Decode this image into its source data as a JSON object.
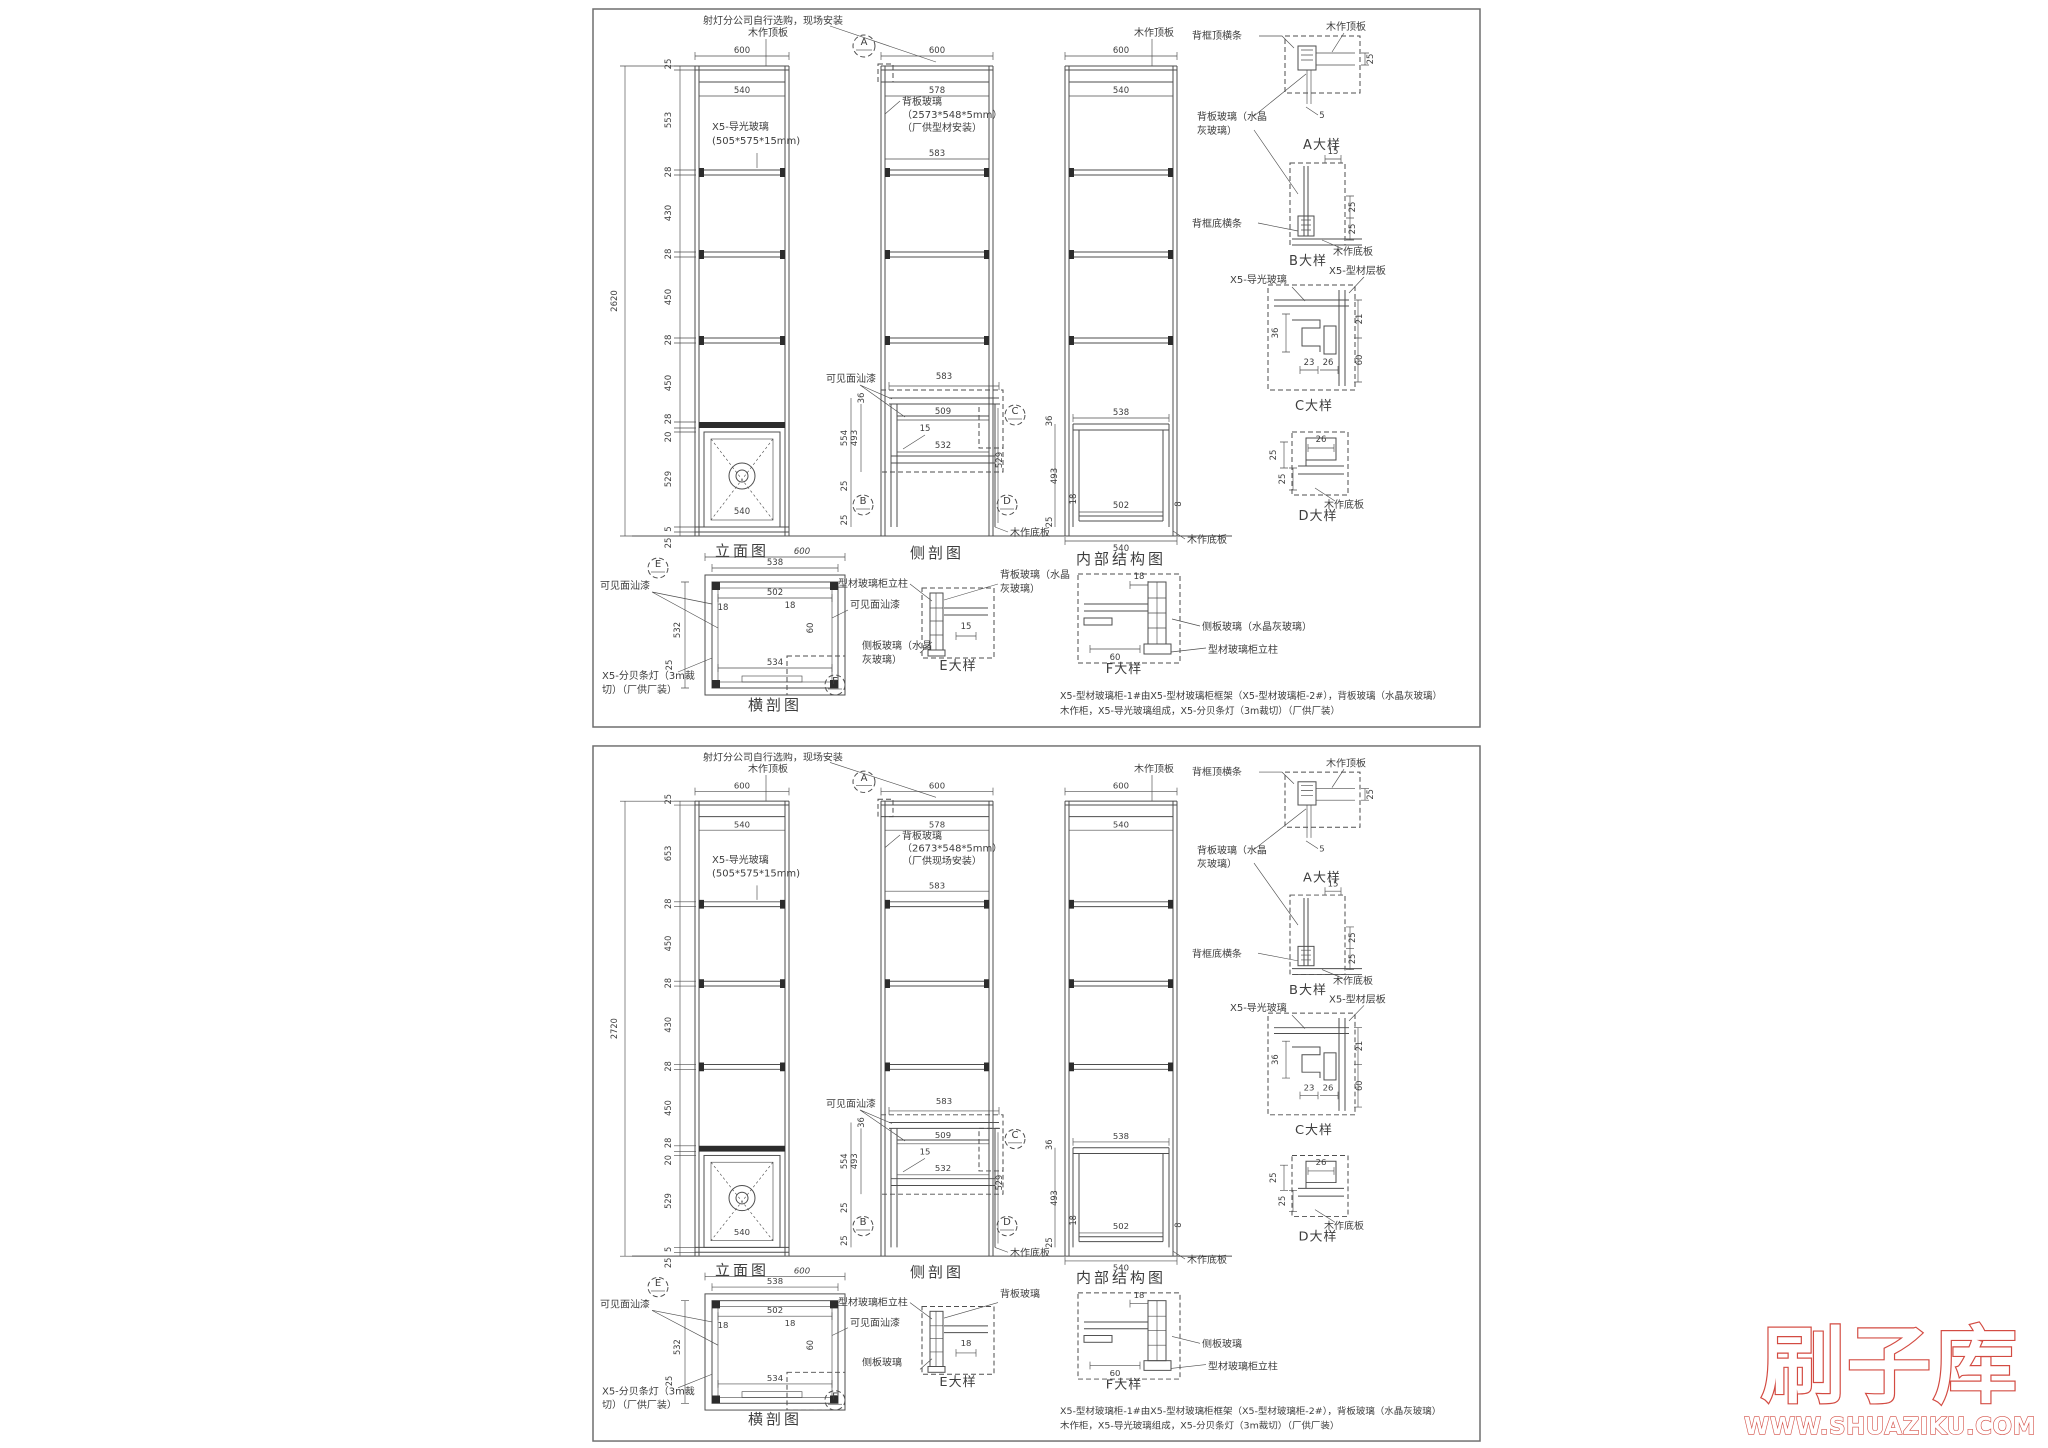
{
  "watermark": {
    "brand": "刷子库",
    "site": "WWW.SHUAZIKU.COM",
    "color": "#d34b42"
  },
  "line_color": "#4e4e4e",
  "sheets": [
    {
      "top_note": "射灯分公司自行选购，现场安装",
      "elev": {
        "title": "立面图",
        "width": "600",
        "inner_width": "540",
        "lamp_width": "540",
        "overall": "2620",
        "segs": [
          "25",
          "553",
          "28",
          "430",
          "28",
          "450",
          "28",
          "450",
          "28",
          "20",
          "529",
          "5",
          "25"
        ],
        "top_panel": "木作顶板",
        "glass1": "X5-导光玻璃",
        "glass2": "(505*575*15mm)"
      },
      "side": {
        "title": "侧剖图",
        "width": "600",
        "inner_top": "578",
        "bg1": "背板玻璃",
        "bg2": "（2573*548*5mm）",
        "bg3": "（厂供型材安装）",
        "shelf_w": "583",
        "marker_a": "A",
        "paint": "可见面汕漆",
        "bench_top": "583",
        "bench_mid": "509",
        "bench_bot": "532",
        "glass_t": "15",
        "h1": "554",
        "h2": "493",
        "h3": "529",
        "t36": "36",
        "b25a": "25",
        "b25b": "25",
        "marker_b": "B",
        "marker_c": "C",
        "marker_d": "D",
        "bottom_panel": "木作底板"
      },
      "inner": {
        "title": "内部结构图",
        "width": "600",
        "inner_width": "540",
        "top_panel": "木作顶板",
        "w538": "538",
        "w502": "502",
        "w540": "540",
        "g8": "8",
        "t36": "36",
        "h493": "493",
        "b18": "18",
        "b25": "25",
        "bottom_panel": "木作底板"
      },
      "cross": {
        "title": "横剖图",
        "width": "600",
        "w538": "538",
        "w502": "502",
        "h532": "532",
        "w534": "534",
        "h60": "60",
        "t18a": "18",
        "t18b": "18",
        "b25": "25",
        "paint_l": "可见面汕漆",
        "paint_r": "可见面汕漆",
        "lamp1": "X5-分贝条灯（3m裁",
        "lamp2": "切）（厂供厂装）",
        "marker_e": "E",
        "marker_f": "F"
      },
      "da": {
        "name": "A大样",
        "rail": "背框顶横条",
        "panel": "木作顶板",
        "g1": "背板玻璃（水晶",
        "g2": "灰玻璃）",
        "d25": "25",
        "d5": "5"
      },
      "db": {
        "name": "B大样",
        "rail": "背框底横条",
        "panel": "木作底板",
        "d15": "15",
        "d25a": "25",
        "d25b": "25",
        "shelf": "X5-型材层板"
      },
      "dc": {
        "name": "C大样",
        "glass": "X5-导光玻璃",
        "d36": "36",
        "d23": "23",
        "d26": "26",
        "d21": "21",
        "d60": "60"
      },
      "dd": {
        "name": "D大样",
        "d26": "26",
        "d25a": "25",
        "d25b": "25",
        "panel": "木作底板"
      },
      "de": {
        "name": "E大样",
        "post": "型材玻璃柜立柱",
        "b1": "背板玻璃（水晶",
        "b2": "灰玻璃）",
        "s1": "侧板玻璃（水晶",
        "s2": "灰玻璃）",
        "d15": "15"
      },
      "df": {
        "name": "F大样",
        "d18": "18",
        "d60": "60",
        "side": "侧板玻璃（水晶灰玻璃）",
        "post": "型材玻璃柜立柱"
      },
      "cap1": "X5-型材玻璃柜-1#由X5-型材玻璃柜框架（X5-型材玻璃柜-2#），背板玻璃（水晶灰玻璃）",
      "cap2": "木作柜，X5-导光玻璃组成，X5-分贝条灯（3m裁切）（厂供厂装）"
    },
    {
      "top_note": "射灯分公司自行选购，现场安装",
      "elev": {
        "title": "立面图",
        "width": "600",
        "inner_width": "540",
        "lamp_width": "540",
        "overall": "2720",
        "segs": [
          "25",
          "653",
          "28",
          "450",
          "28",
          "430",
          "28",
          "450",
          "28",
          "20",
          "529",
          "5",
          "25"
        ],
        "top_panel": "木作顶板",
        "glass1": "X5-导光玻璃",
        "glass2": "(505*575*15mm)"
      },
      "side": {
        "title": "侧剖图",
        "width": "600",
        "inner_top": "578",
        "bg1": "背板玻璃",
        "bg2": "（2673*548*5mm）",
        "bg3": "（厂供现场安装）",
        "shelf_w": "583",
        "marker_a": "A",
        "paint": "可见面汕漆",
        "bench_top": "583",
        "bench_mid": "509",
        "bench_bot": "532",
        "glass_t": "15",
        "h1": "554",
        "h2": "493",
        "h3": "529",
        "t36": "36",
        "b25a": "25",
        "b25b": "25",
        "marker_b": "B",
        "marker_c": "C",
        "marker_d": "D",
        "bottom_panel": "木作底板"
      },
      "inner": {
        "title": "内部结构图",
        "width": "600",
        "inner_width": "540",
        "top_panel": "木作顶板",
        "w538": "538",
        "w502": "502",
        "w540": "540",
        "g8": "8",
        "t36": "36",
        "h493": "493",
        "b18": "18",
        "b25": "25",
        "bottom_panel": "木作底板"
      },
      "cross": {
        "title": "横剖图",
        "width": "600",
        "w538": "538",
        "w502": "502",
        "h532": "532",
        "w534": "534",
        "h60": "60",
        "t18a": "18",
        "t18b": "18",
        "b25": "25",
        "paint_l": "可见面汕漆",
        "paint_r": "可见面汕漆",
        "lamp1": "X5-分贝条灯（3m裁",
        "lamp2": "切）（厂供厂装）",
        "marker_e": "E",
        "marker_f": "F"
      },
      "da": {
        "name": "A大样",
        "rail": "背框顶横条",
        "panel": "木作顶板",
        "g1": "背板玻璃（水晶",
        "g2": "灰玻璃）",
        "d25": "25",
        "d5": "5"
      },
      "db": {
        "name": "B大样",
        "rail": "背框底横条",
        "panel": "木作底板",
        "d15": "15",
        "d25a": "25",
        "d25b": "25",
        "shelf": "X5-型材层板"
      },
      "dc": {
        "name": "C大样",
        "glass": "X5-导光玻璃",
        "d36": "36",
        "d23": "23",
        "d26": "26",
        "d21": "21",
        "d60": "60"
      },
      "dd": {
        "name": "D大样",
        "d26": "26",
        "d25a": "25",
        "d25b": "25",
        "panel": "木作底板"
      },
      "de": {
        "name": "E大样",
        "post": "型材玻璃柜立柱",
        "b1": "背板玻璃",
        "b2": "",
        "s1": "侧板玻璃",
        "s2": "",
        "d15": "18"
      },
      "df": {
        "name": "F大样",
        "d18": "18",
        "d60": "60",
        "side": "侧板玻璃",
        "post": "型材玻璃柜立柱"
      },
      "cap1": "X5-型材玻璃柜-1#由X5-型材玻璃柜框架（X5-型材玻璃柜-2#），背板玻璃（水晶灰玻璃）",
      "cap2": "木作柜，X5-导光玻璃组成，X5-分贝条灯（3m裁切）（厂供厂装）"
    }
  ]
}
